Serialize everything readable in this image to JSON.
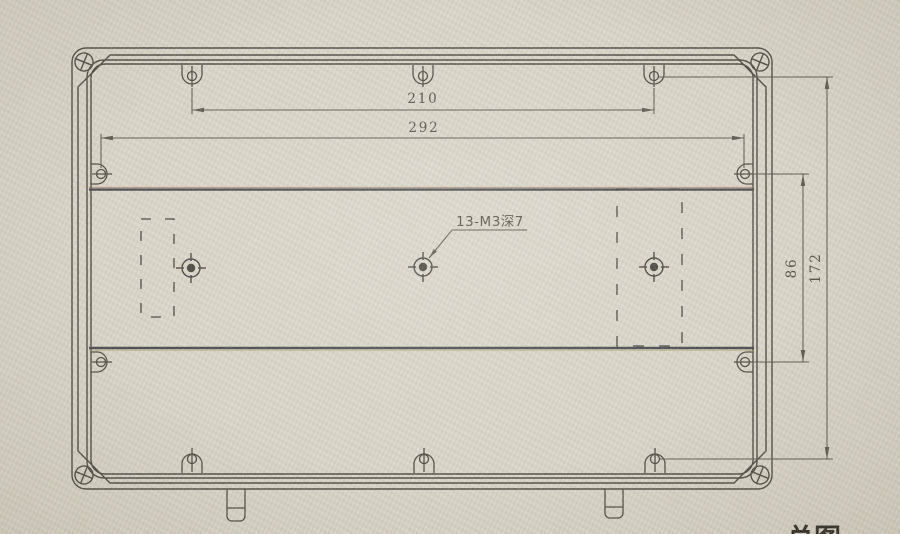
{
  "drawing": {
    "callout": "13-M3深7",
    "dims": {
      "top_inner": "210",
      "top_outer": "292",
      "right_inner": "86",
      "right_outer": "172"
    },
    "caption_partial": "总图",
    "colors": {
      "paper": "#d9d5c8",
      "outline": "#3a362e",
      "dimension_line": "#4a453c",
      "rail": "#32343c",
      "label_text": "#3e3931"
    }
  }
}
